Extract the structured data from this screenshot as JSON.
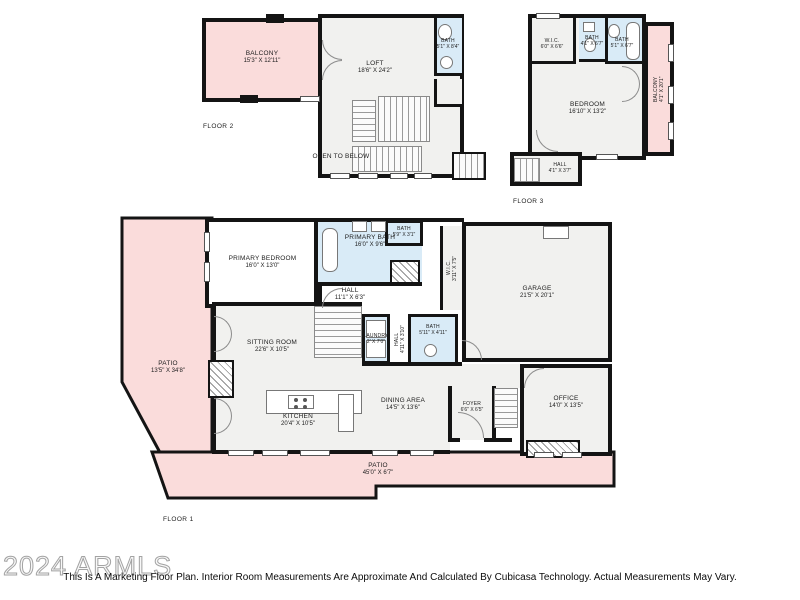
{
  "colors": {
    "patio": "#FADCDB",
    "bath": "#D9EBF7",
    "room": "#F1F1EF",
    "wall": "#141414"
  },
  "floor2": {
    "label": "FLOOR 2",
    "open_to_below": "OPEN TO BELOW",
    "balcony": {
      "name": "BALCONY",
      "dims": "15'3\" X 12'11\""
    },
    "loft": {
      "name": "LOFT",
      "dims": "18'6\" X 24'2\""
    },
    "bath": {
      "name": "BATH",
      "dims": "5'1\" X 8'4\""
    }
  },
  "floor3": {
    "label": "FLOOR 3",
    "wic": {
      "name": "W.I.C.",
      "dims": "6'0\" X 6'6\""
    },
    "bath_a": {
      "name": "BATH",
      "dims": "4'1\" X 6'7\""
    },
    "bath_b": {
      "name": "BATH",
      "dims": "5'1\" X 6'7\""
    },
    "balcony": {
      "name": "BALCONY",
      "dims": "4'1\" X 20'1\""
    },
    "bedroom": {
      "name": "BEDROOM",
      "dims": "16'10\" X 13'2\""
    },
    "hall": {
      "name": "HALL",
      "dims": "4'1\" X 3'7\""
    }
  },
  "floor1": {
    "label": "FLOOR 1",
    "patio_left": {
      "name": "PATIO",
      "dims": "13'5\" X 34'8\""
    },
    "primary_bedroom": {
      "name": "PRIMARY BEDROOM",
      "dims": "16'0\" X 13'0\""
    },
    "primary_bath": {
      "name": "PRIMARY BATH",
      "dims": "16'0\" X 9'6\""
    },
    "bath_small": {
      "name": "BATH",
      "dims": "5'9\" X 3'1\""
    },
    "wic": {
      "name": "W.I.C.",
      "dims": "3'11\" X 7'5\""
    },
    "hall_upper": {
      "name": "HALL",
      "dims": "11'1\" X 6'3\""
    },
    "laundry": {
      "name": "LAUNDRY",
      "dims": "2' X 7'0\""
    },
    "hall_lower": {
      "name": "HALL",
      "dims": "4'11\" X 3'10\""
    },
    "bath_mid": {
      "name": "BATH",
      "dims": "5'11\" X 4'11\""
    },
    "garage": {
      "name": "GARAGE",
      "dims": "21'5\" X 20'1\""
    },
    "sitting_room": {
      "name": "SITTING ROOM",
      "dims": "22'6\" X 10'5\""
    },
    "kitchen": {
      "name": "KITCHEN",
      "dims": "20'4\" X 10'5\""
    },
    "dining": {
      "name": "DINING AREA",
      "dims": "14'5\" X 13'6\""
    },
    "foyer": {
      "name": "FOYER",
      "dims": "6'6\" X 6'5\""
    },
    "office": {
      "name": "OFFICE",
      "dims": "14'0\" X 13'5\""
    },
    "patio_bottom": {
      "name": "PATIO",
      "dims": "45'0\" X 6'7\""
    }
  },
  "footer": {
    "watermark": "2024 ARMLS",
    "disclaimer": "This Is A Marketing Floor Plan. Interior Room Measurements Are Approximate And Calculated By Cubicasa Technology. Actual Measurements May Vary."
  }
}
